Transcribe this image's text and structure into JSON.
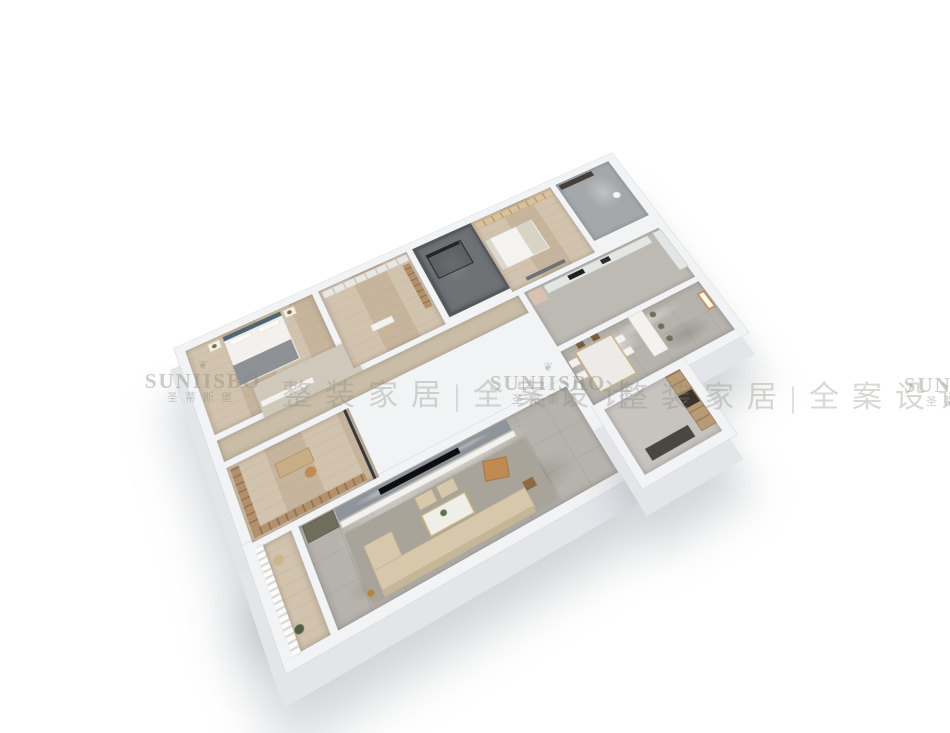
{
  "image": {
    "description": "3D dollhouse-style rendered floor plan of an apartment, viewed from above at an angle on a white background",
    "background": "#ffffff"
  },
  "watermark": {
    "ornament": "❦",
    "brand_latin": "SUNIISBO",
    "brand_cn": "圣蒂斯堡",
    "tagline": "整装家居|全案设计",
    "color": "#8c8a82"
  },
  "palette": {
    "wall": "#f2f3f5",
    "wallline": "#d9dcdf",
    "wallside": "#e3e5e9",
    "wood": "#cdbca5",
    "marble": "#b6b2ac",
    "marblelight": "#c7c4bf",
    "dark": "#6e7275",
    "darkwall": "#55585c",
    "rug": "#a9a49a",
    "sofa": "#d7c8ab",
    "tan": "#c08a52",
    "shelf": "#b3906c",
    "headboard": "#4d6579",
    "tvmarble": "#8f949a",
    "olive": "#6f6d5b",
    "wingwood": "#b89b74",
    "counter": "#e3e6e3",
    "fridge": "#d8c3b3",
    "wmcolor": "#8c8a82"
  },
  "scene": {
    "type": "3d-floorplan-render",
    "rooms": [
      "master-bedroom",
      "walk-in-closet",
      "dark-bathroom",
      "bedroom-2",
      "bathroom-2",
      "corridor",
      "study",
      "kitchen",
      "dining-room",
      "living-room",
      "balcony",
      "entry-hall"
    ]
  }
}
